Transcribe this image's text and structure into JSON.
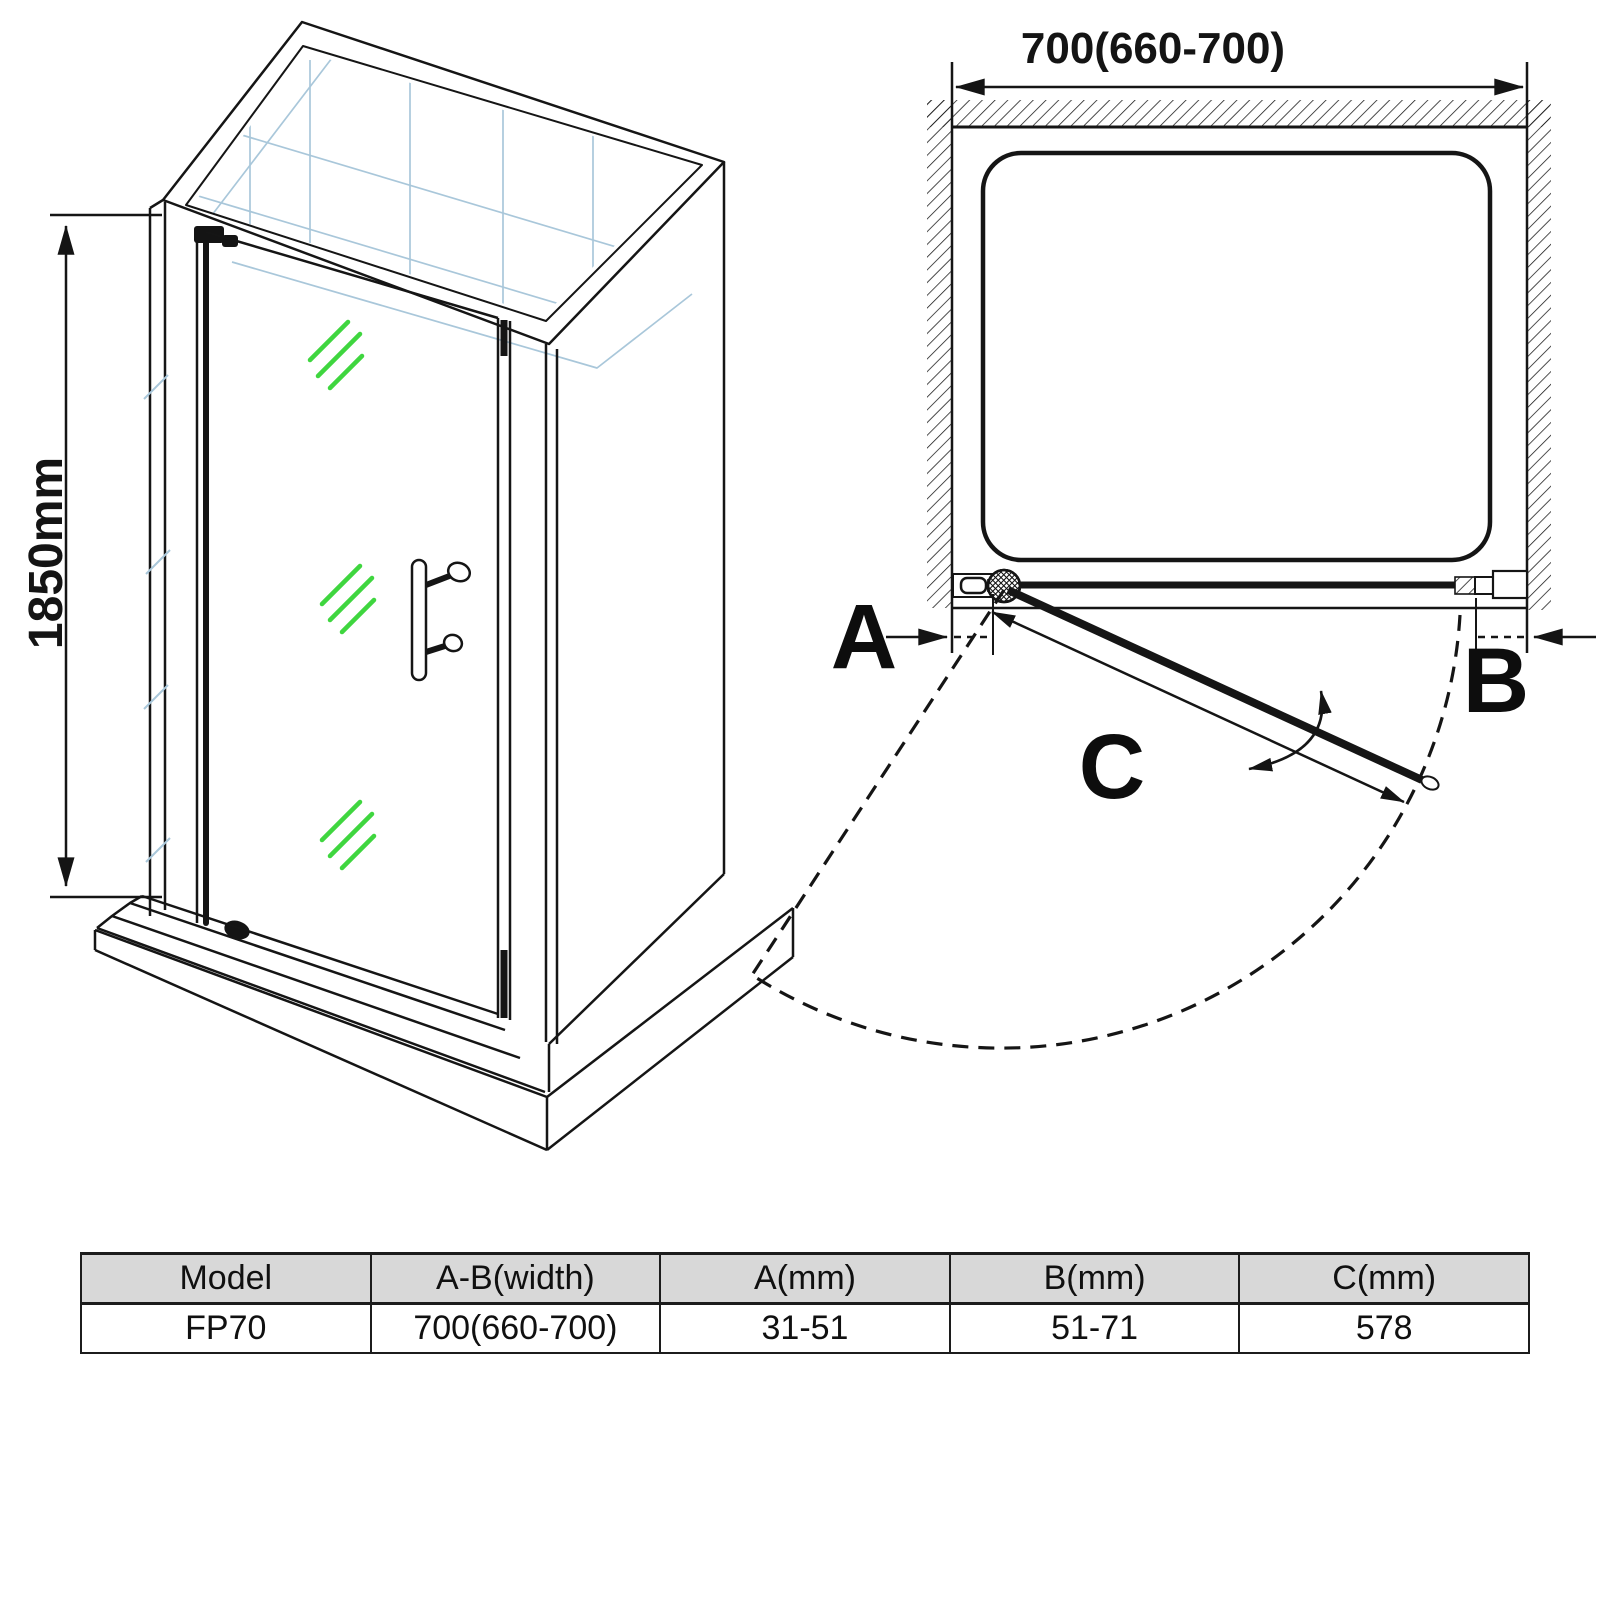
{
  "colors": {
    "line": "#151515",
    "tile_blue": "#a9c7da",
    "glass_green": "#3fd63f",
    "table_header_bg": "#d8d8d8"
  },
  "iso_view": {
    "height_label": "1850mm"
  },
  "plan_view": {
    "width_label": "700(660-700)",
    "label_a": "A",
    "label_b": "B",
    "label_c": "C"
  },
  "spec_table": {
    "headers": [
      "Model",
      "A-B(width)",
      "A(mm)",
      "B(mm)",
      "C(mm)"
    ],
    "rows": [
      [
        "FP70",
        "700(660-700)",
        "31-51",
        "51-71",
        "578"
      ]
    ]
  }
}
